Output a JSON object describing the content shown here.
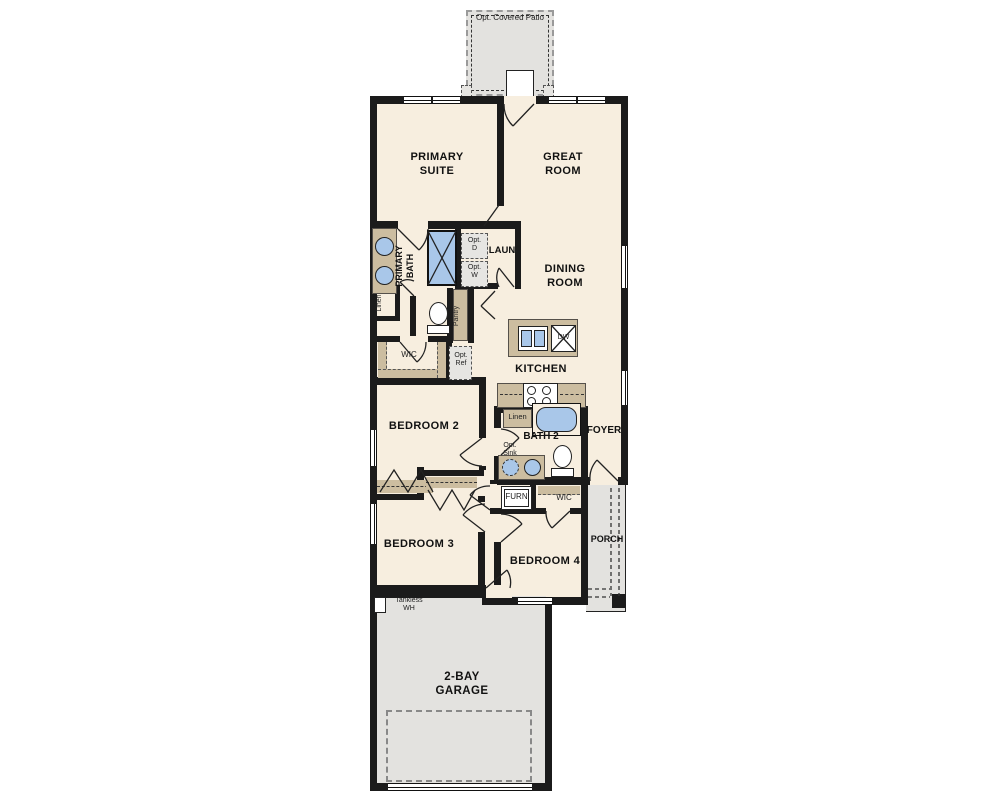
{
  "colors": {
    "floor": "#f7eedf",
    "exterior_gray": "#e3e2df",
    "cabinet_tan": "#ccbda0",
    "fixture_blue": "#a9c7e9",
    "wall_black": "#1b1b1b"
  },
  "labels": {
    "patio": "Opt. Covered Patio",
    "primary_suite": "PRIMARY\nSUITE",
    "great_room": "GREAT\nROOM",
    "dining_room": "DINING\nROOM",
    "primary_bath": "PRIMARY\nBATH",
    "linen_primary": "Linen",
    "laundry": "LAUN",
    "opt_dryer": "Opt.\nD",
    "opt_washer": "Opt.\nW",
    "pantry": "Pantry",
    "wic_primary": "WIC",
    "opt_ref": "Opt.\nRef",
    "kitchen": "KITCHEN",
    "dishwasher": "DW",
    "linen_bath2": "Linen",
    "bath2": "BATH 2",
    "foyer": "FOYER",
    "opt_sink": "Opt.\nSink",
    "bedroom2": "BEDROOM 2",
    "furnace": "FURN",
    "wic_bed4": "WIC",
    "bedroom3": "BEDROOM 3",
    "bedroom4": "BEDROOM 4",
    "porch": "PORCH",
    "tankless_wh": "Tankless\nWH",
    "garage": "2-BAY\nGARAGE"
  }
}
